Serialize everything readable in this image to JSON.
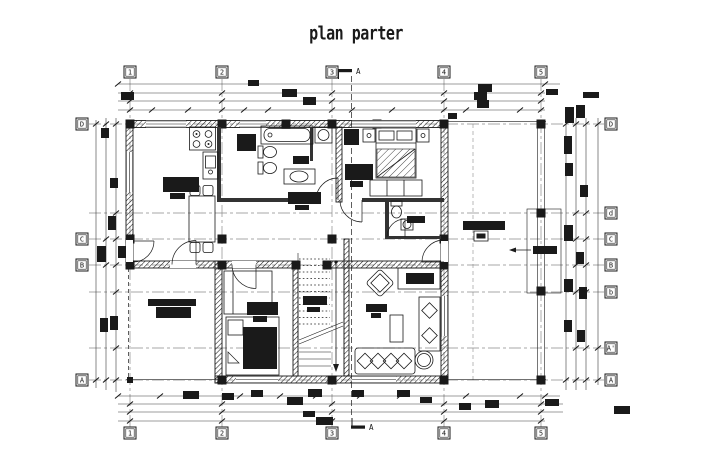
{
  "title": "plan parter",
  "colors": {
    "ink": "#1a1a1a",
    "axis": "#8a8a8a",
    "background": "#ffffff"
  },
  "axes": {
    "columns_top": [
      "1",
      "2",
      "3",
      "4",
      "5"
    ],
    "columns_bottom": [
      "1",
      "2",
      "3",
      "4",
      "5"
    ],
    "rows_left": [
      "D",
      "C",
      "B",
      "A"
    ],
    "rows_right": [
      "D",
      "d",
      "C",
      "B",
      "b",
      "A'",
      "A"
    ],
    "section_label_top": "A",
    "section_label_bottom": "A"
  }
}
